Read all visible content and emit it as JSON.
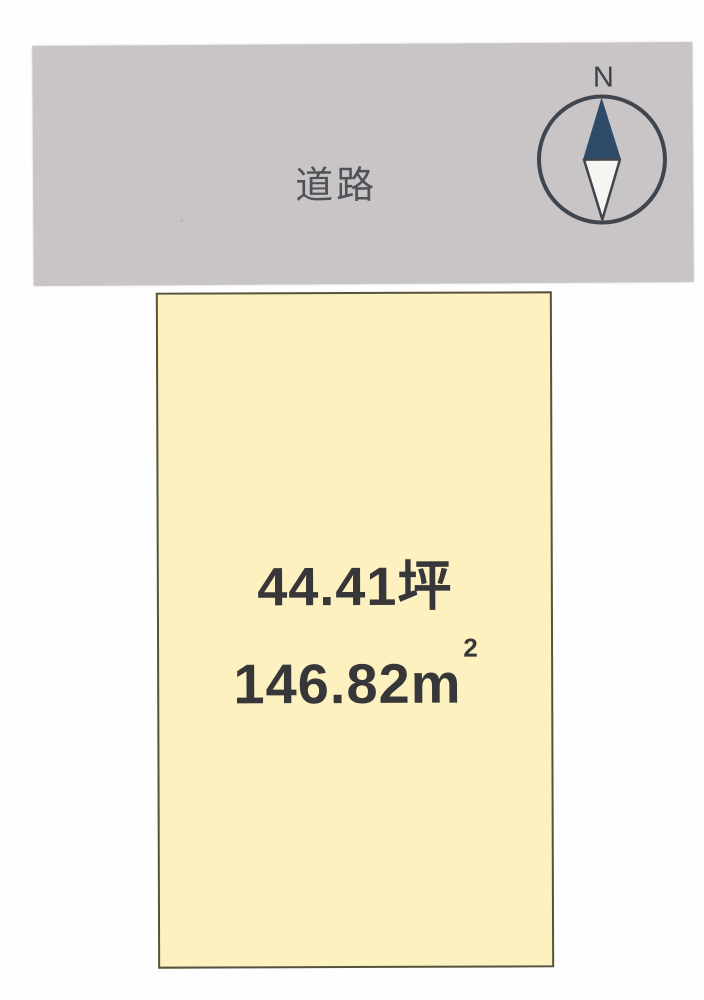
{
  "diagram": {
    "type": "land-plot-layout",
    "background_color": "#fefefe"
  },
  "road": {
    "label": "道路",
    "fill_color": "#c9c5c7",
    "text_color": "#515257"
  },
  "compass": {
    "north_label": "N",
    "ring_color": "#41464e",
    "needle_north_color": "#2d4b68",
    "needle_south_color": "#f7f5f1"
  },
  "plot": {
    "area_tsubo": "44.41坪",
    "area_m2": {
      "value": "146.82",
      "unit": "m",
      "exponent": "2"
    },
    "fill_color": "#fcf1bf",
    "border_color": "#55533d",
    "text_color": "#37373a"
  }
}
